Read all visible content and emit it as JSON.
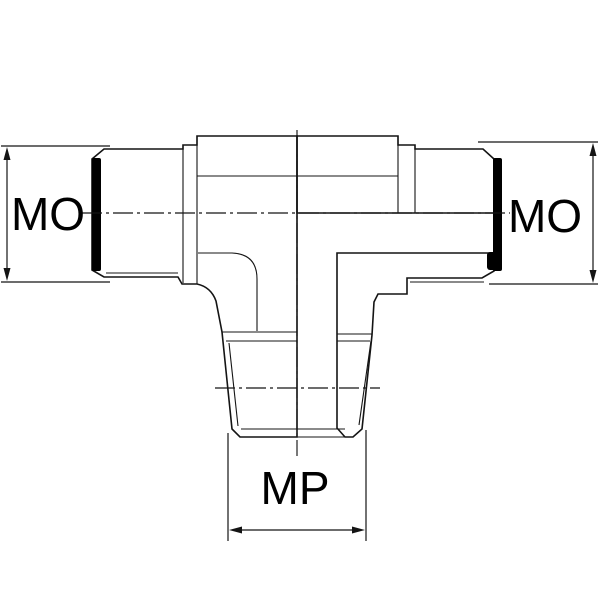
{
  "drawing": {
    "kind": "tee-fitting-cross-section",
    "labels": {
      "left_dimension": "MO",
      "right_dimension": "MO",
      "bottom_dimension": "MP"
    }
  },
  "colors": {
    "background": "#ffffff",
    "body_fill": "#c9c9c9",
    "seal_band": "#000000",
    "line": "#141414"
  }
}
